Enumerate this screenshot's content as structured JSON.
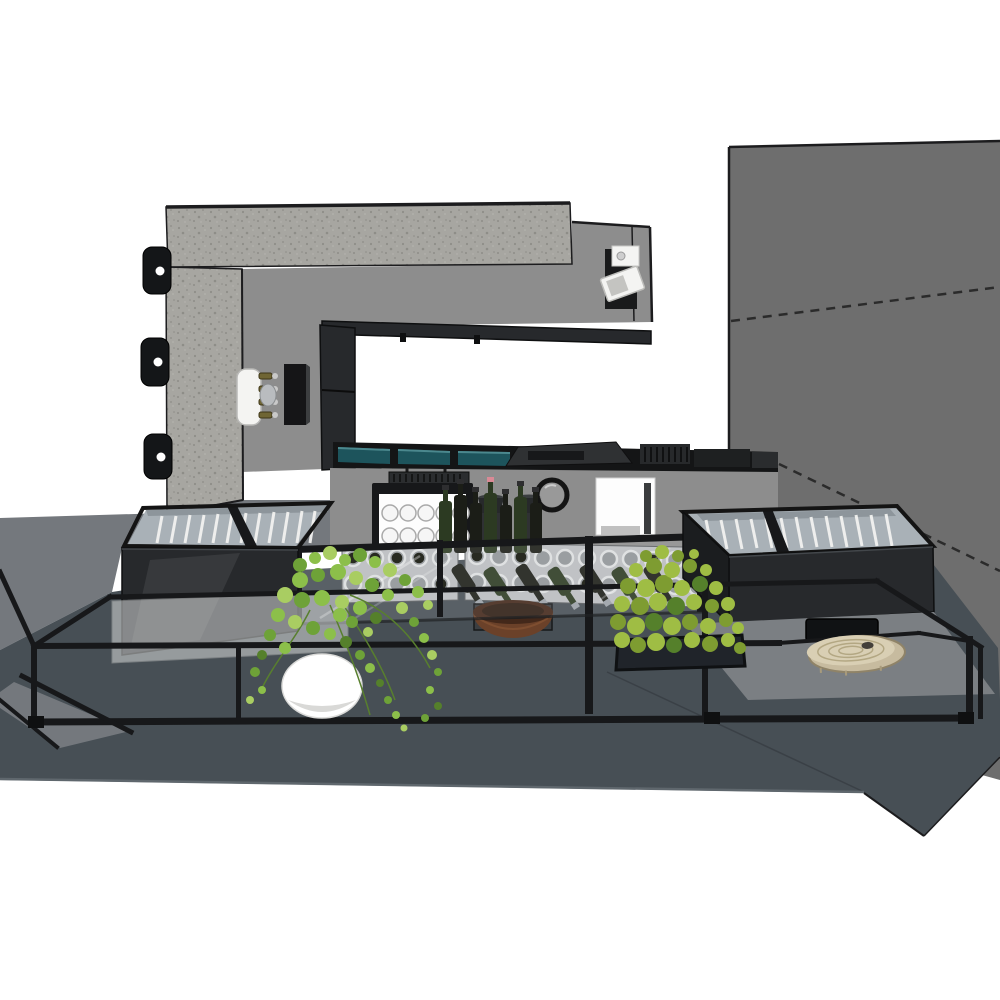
{
  "scene": {
    "type": "3d-architectural-render",
    "description": "SketchUp-style monochrome render of a bar counter: concrete portal frame with service opening, back bar with lit glassware cabinet, coffee grinders, round mirror and service window, front glass display with wine racks and bottles, two charcoal display chillers with glazed tops, trailing ivy plant in a white pot, a box planter, a wood-slice serving board, all wrapped by a black glass-guard railing on a dark raised floor against a grey wall",
    "render_style": "flat-shaded line render, no text labels",
    "background": "#ffffff"
  },
  "objects": [
    {
      "name": "right-wall",
      "note": "dark grey wall with dashed hidden-geometry lines"
    },
    {
      "name": "concrete-portal",
      "note": "speckled concrete beam and column"
    },
    {
      "name": "wall-brackets",
      "note": "three black mounting brackets on column edge"
    },
    {
      "name": "beer-tap-tower",
      "note": "white tower with four taps"
    },
    {
      "name": "menu-board",
      "note": "small black panel on wall"
    },
    {
      "name": "ceiling-projector",
      "note": "white spotlight fixture at beam end"
    },
    {
      "name": "service-opening",
      "note": "black framed opening above back counter"
    },
    {
      "name": "back-counter",
      "note": "black top with teal glass panels and appliances"
    },
    {
      "name": "glassware-cabinet",
      "note": "lit cabinet with two rows of glasses"
    },
    {
      "name": "coffee-grinders",
      "note": "two dark grinders"
    },
    {
      "name": "round-mirror",
      "note": "black ring mirror"
    },
    {
      "name": "service-window",
      "note": "white niche with dark stripe"
    },
    {
      "name": "wine-racks",
      "note": "perforated panels, some holes holding bottles"
    },
    {
      "name": "standing-bottles",
      "note": "row of dark bottles on shelf"
    },
    {
      "name": "tilted-bottles",
      "note": "display bottles angled downward"
    },
    {
      "name": "display-glass-case",
      "note": "glass sneeze guard over front counter"
    },
    {
      "name": "fruit-bowl",
      "note": "brown bowl on dark stand"
    },
    {
      "name": "left-display-chiller",
      "note": "charcoal chest with glazed top and white slats"
    },
    {
      "name": "right-display-chiller",
      "note": "charcoal chest with glazed top and white slats"
    },
    {
      "name": "wall-niche",
      "note": "black recess in bench"
    },
    {
      "name": "wood-slice-board",
      "note": "live-edge wood slice with growth rings"
    },
    {
      "name": "glass-guard-railing",
      "note": "black perimeter railing with glass panel"
    },
    {
      "name": "hanging-ivy-plant",
      "note": "ivy trailing from white round pot"
    },
    {
      "name": "planter-box-plant",
      "note": "dense leafy plant in dark box"
    },
    {
      "name": "raised-floor",
      "note": "dark slate platform over light grey walkway"
    }
  ],
  "colors": {
    "background": "#ffffff",
    "outline": "#1c1c1e",
    "concrete": "#a7a6a1",
    "concrete_speckle": "#8e8d88",
    "panel_gray": "#8d8d8d",
    "panel_gray_dark": "#7e7f80",
    "right_wall": "#6e6e6e",
    "dash_color": "#2b2b2b",
    "floor_dark": "#474f55",
    "floor_light": "#74787d",
    "floor_edge": "#5f676d",
    "black_metal": "#17181a",
    "case_body": "#27292c",
    "case_glass": "#a9b1b7",
    "case_slat": "#f2f2f0",
    "teal_glass": "#1d545c",
    "teal_glass_light": "#4b888e",
    "counter_black": "#141516",
    "appliance_gray": "#2f3133",
    "rack_panel": "#b9bcbf",
    "rack_hole": "#8f9397",
    "rack_rim": "#dcdedf",
    "bottle_dark": "#1b1d17",
    "bottle_green": "#2c3a22",
    "bottle_pink": "#d98a96",
    "bowl_brown": "#6b4129",
    "bowl_brown_dark": "#43281a",
    "stand_gray": "#3b3e41",
    "wood_slice": "#d9cfb4",
    "wood_slice_side": "#c7bb9f",
    "wood_ring": "#b3a783",
    "wood_knot": "#44403a",
    "leaf_green_1": "#8cbf4a",
    "leaf_green_2": "#6ea238",
    "leaf_green_3": "#a9cd62",
    "leaf_green_dark": "#55802b",
    "planter_leaf_1": "#9fbd44",
    "planter_leaf_2": "#7e9c31",
    "pot_white": "#ffffff",
    "pot_shade": "#d9d9d7",
    "cabinet_white": "#fdfdfd",
    "glass_white": "#f6f6f6",
    "mirror_ring": "#141414",
    "mirror_face": "#9a9a9a",
    "window_stripe": "#3a3c3e",
    "tap_white": "#f4f4f2",
    "tap_gold": "#6f6534",
    "steel": "#c9c9c9",
    "glassguard": "#d7d9d9",
    "bracket_black": "#141618",
    "bench_gray": "#7b7f83"
  }
}
